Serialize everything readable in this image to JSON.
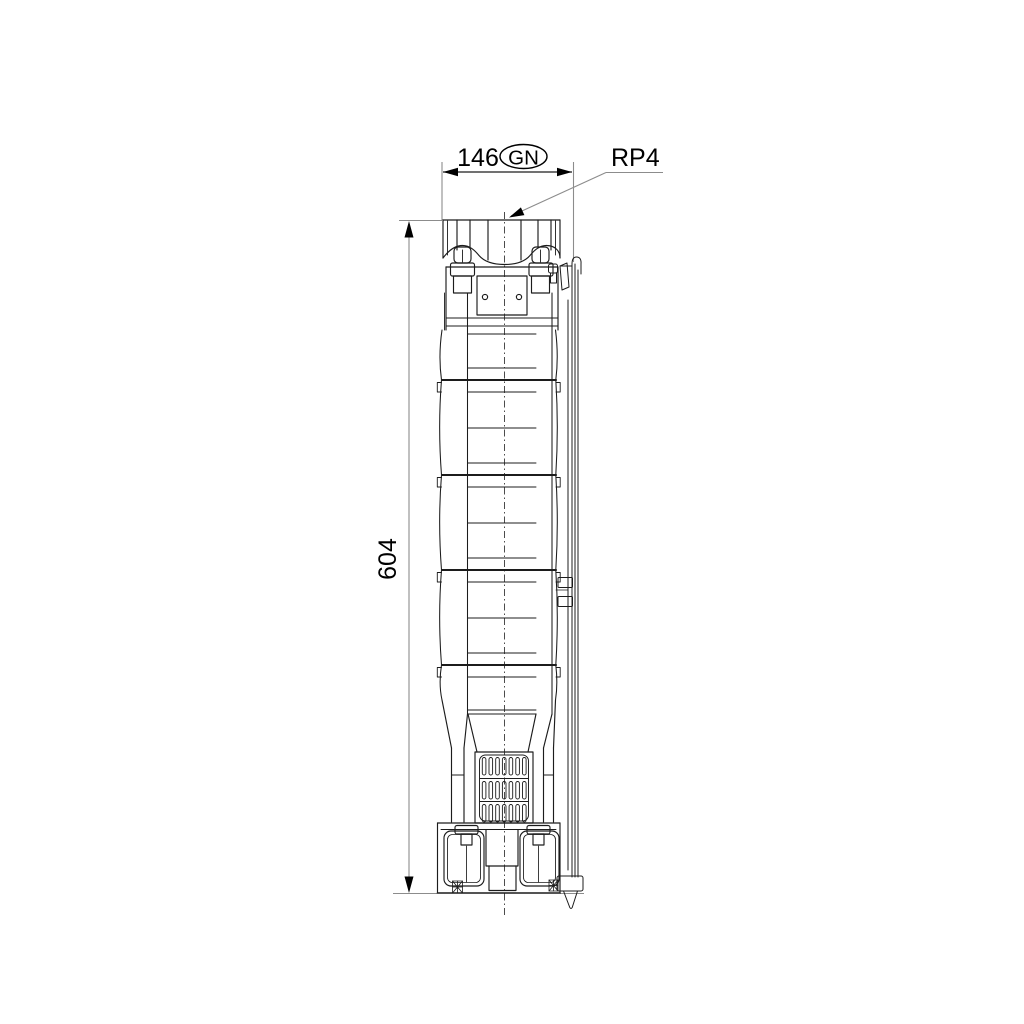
{
  "drawing_type": "pump-dimensional-technical-drawing",
  "labels": {
    "width_dimension": "146",
    "width_badge": "GN",
    "connection": "RP4",
    "height_dimension": "604"
  },
  "colors": {
    "background": "#ffffff",
    "object_line": "#1c1c1c",
    "dim_line": "#8c8c8c",
    "arrow": "#000000",
    "text": "#000000"
  }
}
